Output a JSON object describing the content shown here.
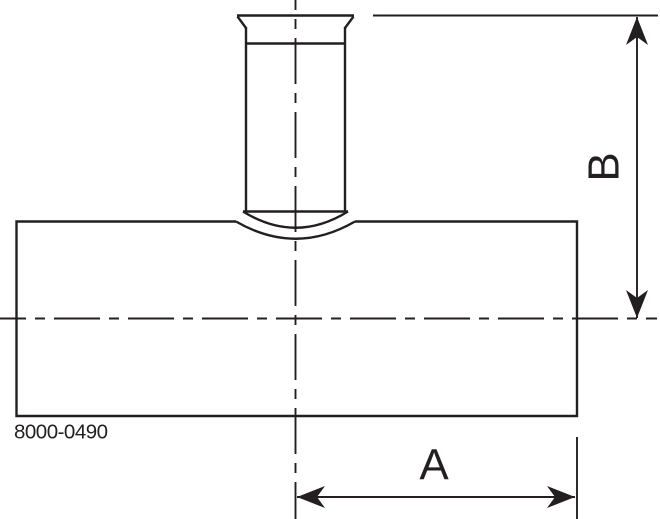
{
  "drawing": {
    "part_number": "8000-0490",
    "dimensions": {
      "horizontal_label": "A",
      "vertical_label": "B"
    },
    "line_color": "#231f20",
    "background_color": "#ffffff"
  }
}
